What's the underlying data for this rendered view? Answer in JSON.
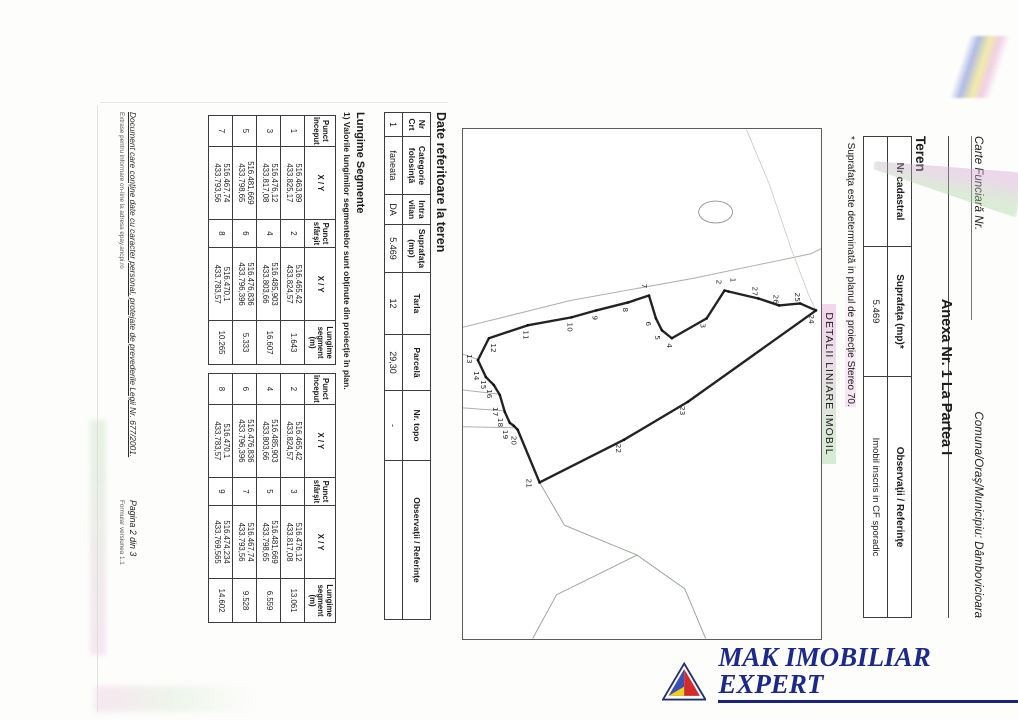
{
  "header": {
    "carte": "Carte Funciară Nr.",
    "comuna": "Comuna/Oraş/Municipiu: Dâmbovicioara"
  },
  "anexa_title": "Anexa Nr. 1 La Partea I",
  "teren": {
    "title": "Teren",
    "headers": [
      "Nr cadastral",
      "Suprafaţa (mp)*",
      "Observaţii / Referinţe"
    ],
    "row": {
      "nr_cadastral": "",
      "suprafata": "5.469",
      "observatii": "Imobil inscris in CF sporadic"
    },
    "note": "* Suprafaţa este determinată in planul de proiecţie Stereo 70.",
    "detalii_title": "DETALII LINIARE IMOBIL"
  },
  "land": {
    "title": "Date referitoare la teren",
    "headers": [
      "Nr Crt",
      "Categorie folosinţă",
      "Intra vilan",
      "Suprafaţa (mp)",
      "Tarla",
      "Parcelă",
      "Nr. topo",
      "Observaţii / Referinţe"
    ],
    "row": [
      "1",
      "faneata",
      "DA",
      "5.469",
      "12",
      "29,30",
      "-",
      ""
    ]
  },
  "segments": {
    "title": "Lungime Segmente",
    "note": "1) Valorile lungimilor segmentelor sunt obţinute din proiecţie în plan.",
    "headers": [
      "Punct început",
      "X / Y",
      "Punct sfârşit",
      "X / Y",
      "Lungime segment (m)"
    ],
    "table_a": [
      [
        "1",
        "516.463,89",
        "433.825,17",
        "2",
        "516.465,42",
        "433.824,57",
        "1.643"
      ],
      [
        "3",
        "516.476,12",
        "433.817,08",
        "4",
        "516.485,903",
        "433.803,66",
        "16.607"
      ],
      [
        "5",
        "516.481,669",
        "433.798,65",
        "6",
        "516.476,836",
        "433.796,396",
        "5.333"
      ],
      [
        "7",
        "516.467,74",
        "433.793,56",
        "8",
        "516.470,1",
        "433.783,57",
        "10.265"
      ]
    ],
    "table_b": [
      [
        "2",
        "516.465,42",
        "433.824,57",
        "3",
        "516.476,12",
        "433.817,08",
        "13.061"
      ],
      [
        "4",
        "516.485,903",
        "433.803,66",
        "5",
        "516.481,669",
        "433.798,65",
        "6.559"
      ],
      [
        "6",
        "516.476,836",
        "433.796,396",
        "7",
        "516.467,74",
        "433.793,56",
        "9.528"
      ],
      [
        "8",
        "516.470,1",
        "433.783,57",
        "9",
        "516.474,234",
        "433.769,565",
        "14.602"
      ]
    ]
  },
  "footer": {
    "left1": "Document care conţine date cu caracter personal, protejate de prevederile Legii Nr. 677/2001.",
    "left2": "Extrase pentru informare on-line la adresa epay.ancpi.ro",
    "page": "Pagina 2 din 3",
    "form": "Formular versiunea 1.1"
  },
  "logo": {
    "text": "MAK IMOBILIAR EXPERT",
    "color": "#1b2a8a",
    "triangle": {
      "blue": "#3a50b4",
      "red": "#d22b2b",
      "yellow": "#f0cf1f"
    }
  },
  "map": {
    "polygon": [
      {
        "n": "24",
        "x": 182,
        "y": 5,
        "lx": 186,
        "ly": 12
      },
      {
        "n": "25",
        "x": 175,
        "y": 21,
        "lx": 164,
        "ly": 26
      },
      {
        "n": "26",
        "x": 177,
        "y": 42,
        "lx": 166,
        "ly": 48
      },
      {
        "n": "27",
        "x": 170,
        "y": 63,
        "lx": 158,
        "ly": 69
      },
      {
        "n": "1",
        "x": 163,
        "y": 93,
        "lx": 149,
        "ly": 91
      },
      {
        "n": "2",
        "x": 162,
        "y": 97,
        "lx": 151,
        "ly": 105
      },
      {
        "n": "3",
        "x": 190,
        "y": 115,
        "lx": 195,
        "ly": 121
      },
      {
        "n": "4",
        "x": 210,
        "y": 150,
        "lx": 215,
        "ly": 155
      },
      {
        "n": "5",
        "x": 202,
        "y": 160,
        "lx": 207,
        "ly": 167
      },
      {
        "n": "6",
        "x": 190,
        "y": 166,
        "lx": 193,
        "ly": 176
      },
      {
        "n": "7",
        "x": 167,
        "y": 173,
        "lx": 155,
        "ly": 180
      },
      {
        "n": "8",
        "x": 174,
        "y": 194,
        "lx": 179,
        "ly": 199
      },
      {
        "n": "9",
        "x": 182,
        "y": 226,
        "lx": 187,
        "ly": 230
      },
      {
        "n": "10",
        "x": 189,
        "y": 251,
        "lx": 194,
        "ly": 255
      },
      {
        "n": "11",
        "x": 197,
        "y": 295,
        "lx": 202,
        "ly": 299
      },
      {
        "n": "12",
        "x": 210,
        "y": 334,
        "lx": 215,
        "ly": 332
      },
      {
        "n": "13",
        "x": 232,
        "y": 345,
        "lx": 226,
        "ly": 356
      },
      {
        "n": "14",
        "x": 249,
        "y": 337,
        "lx": 243,
        "ly": 349
      },
      {
        "n": "15",
        "x": 257,
        "y": 329,
        "lx": 252,
        "ly": 342
      },
      {
        "n": "16",
        "x": 267,
        "y": 323,
        "lx": 261,
        "ly": 336
      },
      {
        "n": "17",
        "x": 284,
        "y": 318,
        "lx": 279,
        "ly": 330
      },
      {
        "n": "18",
        "x": 295,
        "y": 313,
        "lx": 290,
        "ly": 325
      },
      {
        "n": "19",
        "x": 298,
        "y": 309,
        "lx": 302,
        "ly": 320
      },
      {
        "n": "20",
        "x": 302,
        "y": 305,
        "lx": 308,
        "ly": 311
      },
      {
        "n": "21",
        "x": 355,
        "y": 283,
        "lx": 351,
        "ly": 296
      },
      {
        "n": "22",
        "x": 312,
        "y": 198,
        "lx": 316,
        "ly": 206
      },
      {
        "n": "23",
        "x": 274,
        "y": 134,
        "lx": 278,
        "ly": 142
      }
    ],
    "lines": [
      {
        "points": "199,360 172,252 150,130 125,10 120,0",
        "c": "#a9b5a5",
        "w": 1
      },
      {
        "points": "226,360 231,346",
        "c": "#a9b5a5",
        "w": 1
      },
      {
        "points": "262,360 266,325",
        "c": "#a9b5a5",
        "w": 1
      },
      {
        "points": "280,360 283,319",
        "c": "#a9b5a5",
        "w": 1
      },
      {
        "points": "299,360 300,306",
        "c": "#a9b5a5",
        "w": 1
      },
      {
        "points": "355,283 398,258 428,185 462,137 512,116",
        "c": "#9aa79a",
        "w": 1
      },
      {
        "points": "428,185 468,266 512,290",
        "c": "#9aa79a",
        "w": 1
      },
      {
        "points": "0,75 55,52 120,30 165,13",
        "c": "#c3cbc0",
        "w": 0.8
      },
      {
        "points": "165,13 182,5",
        "c": "#c3cbc0",
        "w": 0.8
      }
    ],
    "ellipse": {
      "cx": 83,
      "cy": 106,
      "rx": 11,
      "ry": 17
    }
  }
}
